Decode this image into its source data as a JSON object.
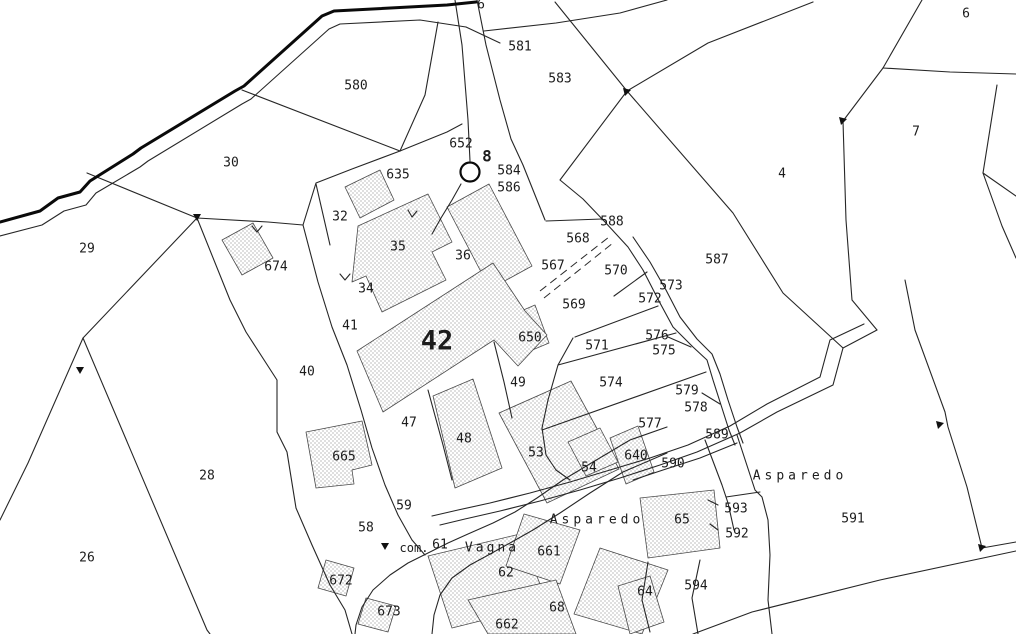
{
  "map": {
    "kind": "cadastral parcel plan",
    "background_color": "#ffffff",
    "line_color": "#262626",
    "highlight_color": "#1fe0e0",
    "building_hatch_color": "#a6a6a6",
    "selected_parcel_ids": [
      "42",
      "567",
      "569"
    ],
    "landmark": {
      "symbol": "well-circle",
      "label": "8"
    },
    "locality_names": [
      "Asparedo",
      "Vagna"
    ],
    "labels": [
      {
        "t": "6",
        "x": 481,
        "y": 4
      },
      {
        "t": "581",
        "x": 520,
        "y": 46
      },
      {
        "t": "580",
        "x": 356,
        "y": 85
      },
      {
        "t": "583",
        "x": 560,
        "y": 78
      },
      {
        "t": "6",
        "x": 966,
        "y": 13
      },
      {
        "t": "7",
        "x": 916,
        "y": 131
      },
      {
        "t": "4",
        "x": 782,
        "y": 173
      },
      {
        "t": "652",
        "x": 461,
        "y": 143
      },
      {
        "t": "8",
        "x": 487,
        "y": 156,
        "s": 16,
        "b": true
      },
      {
        "t": "584",
        "x": 509,
        "y": 170
      },
      {
        "t": "586",
        "x": 509,
        "y": 187
      },
      {
        "t": "30",
        "x": 231,
        "y": 162
      },
      {
        "t": "635",
        "x": 398,
        "y": 174
      },
      {
        "t": "32",
        "x": 340,
        "y": 216
      },
      {
        "t": "588",
        "x": 612,
        "y": 221
      },
      {
        "t": "568",
        "x": 578,
        "y": 238
      },
      {
        "t": "29",
        "x": 87,
        "y": 248
      },
      {
        "t": "674",
        "x": 276,
        "y": 266
      },
      {
        "t": "35",
        "x": 398,
        "y": 246
      },
      {
        "t": "36",
        "x": 463,
        "y": 255
      },
      {
        "t": "567",
        "x": 553,
        "y": 265
      },
      {
        "t": "570",
        "x": 616,
        "y": 270
      },
      {
        "t": "587",
        "x": 717,
        "y": 259
      },
      {
        "t": "573",
        "x": 671,
        "y": 285
      },
      {
        "t": "572",
        "x": 650,
        "y": 298
      },
      {
        "t": "34",
        "x": 366,
        "y": 288
      },
      {
        "t": "569",
        "x": 574,
        "y": 304
      },
      {
        "t": "41",
        "x": 350,
        "y": 325
      },
      {
        "t": "42",
        "x": 437,
        "y": 340,
        "s": 27,
        "b": true
      },
      {
        "t": "650",
        "x": 530,
        "y": 337
      },
      {
        "t": "571",
        "x": 597,
        "y": 345
      },
      {
        "t": "576",
        "x": 657,
        "y": 335
      },
      {
        "t": "575",
        "x": 664,
        "y": 350
      },
      {
        "t": "40",
        "x": 307,
        "y": 371
      },
      {
        "t": "574",
        "x": 611,
        "y": 382
      },
      {
        "t": "49",
        "x": 518,
        "y": 382
      },
      {
        "t": "579",
        "x": 687,
        "y": 390
      },
      {
        "t": "578",
        "x": 696,
        "y": 407
      },
      {
        "t": "47",
        "x": 409,
        "y": 422
      },
      {
        "t": "577",
        "x": 650,
        "y": 423
      },
      {
        "t": "665",
        "x": 344,
        "y": 456
      },
      {
        "t": "48",
        "x": 464,
        "y": 438
      },
      {
        "t": "53",
        "x": 536,
        "y": 452
      },
      {
        "t": "54",
        "x": 589,
        "y": 467
      },
      {
        "t": "640",
        "x": 636,
        "y": 455
      },
      {
        "t": "589",
        "x": 717,
        "y": 434
      },
      {
        "t": "28",
        "x": 207,
        "y": 475
      },
      {
        "t": "590",
        "x": 673,
        "y": 463
      },
      {
        "t": "Asparedo",
        "x": 800,
        "y": 475,
        "ls": 4
      },
      {
        "t": "59",
        "x": 404,
        "y": 505
      },
      {
        "t": "65",
        "x": 682,
        "y": 519
      },
      {
        "t": "591",
        "x": 853,
        "y": 518
      },
      {
        "t": "593",
        "x": 736,
        "y": 508
      },
      {
        "t": "58",
        "x": 366,
        "y": 527
      },
      {
        "t": "592",
        "x": 737,
        "y": 533
      },
      {
        "t": "Asparedo",
        "x": 597,
        "y": 519,
        "ls": 4
      },
      {
        "t": "com.",
        "x": 414,
        "y": 548,
        "s": 12
      },
      {
        "t": "61",
        "x": 440,
        "y": 544
      },
      {
        "t": "Vagna",
        "x": 492,
        "y": 547,
        "ls": 3
      },
      {
        "t": "661",
        "x": 549,
        "y": 551
      },
      {
        "t": "672",
        "x": 341,
        "y": 580
      },
      {
        "t": "62",
        "x": 506,
        "y": 572
      },
      {
        "t": "64",
        "x": 645,
        "y": 591
      },
      {
        "t": "594",
        "x": 696,
        "y": 585
      },
      {
        "t": "673",
        "x": 389,
        "y": 611
      },
      {
        "t": "68",
        "x": 557,
        "y": 607
      },
      {
        "t": "662",
        "x": 507,
        "y": 624
      },
      {
        "t": "26",
        "x": 87,
        "y": 557
      }
    ]
  }
}
